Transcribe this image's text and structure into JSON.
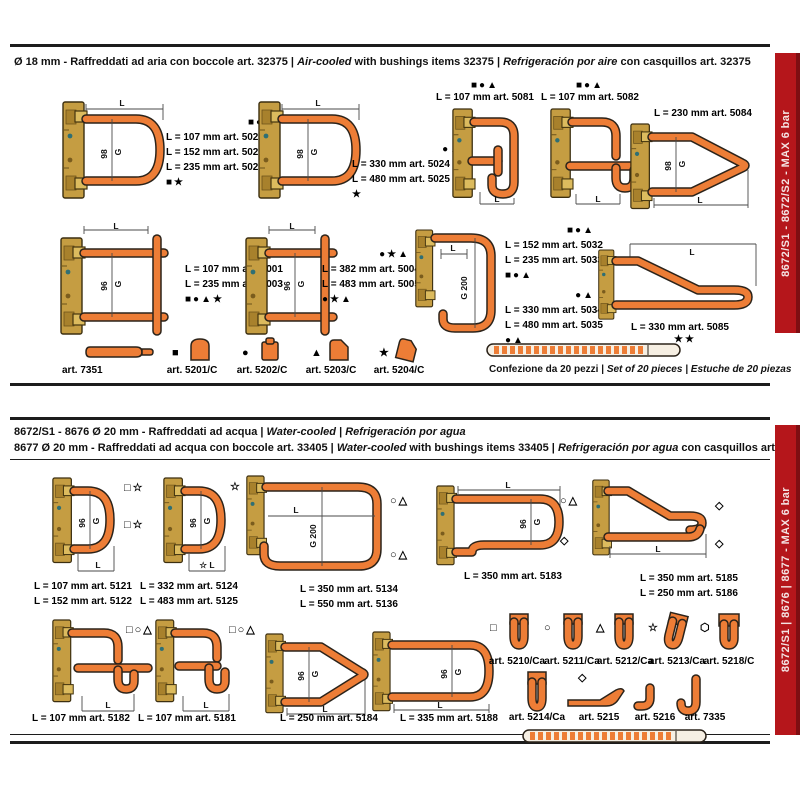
{
  "colors": {
    "red": "#b5161b",
    "red_dark": "#7e0e12",
    "orange": "#ed7d36",
    "brass": "#c59d42"
  },
  "dims": {
    "L": "L",
    "g98": "98",
    "g96": "96",
    "G": "G",
    "G200": "G 200"
  },
  "top": {
    "sidebar": "8672/S1 - 8672/S2  -  MAX 6 bar",
    "header": {
      "p1": "Ø 18 mm - Raffreddati ad aria con boccole art. 32375 | ",
      "p2i": "Air-cooled",
      "p2": " with bushings items 32375 | ",
      "p3i": "Refrigeración por aire",
      "p3": " con casquillos art. 32375"
    },
    "g1": {
      "sym_top": "■●▲",
      "l1": "L = 107 mm art. 5021",
      "l2": "L = 152 mm art. 5022",
      "l3": "L = 235 mm art. 5023",
      "sym_bottom": "■★"
    },
    "g2": {
      "sym_top": "●▲",
      "l1": "L = 330 mm art. 5024",
      "l2": "L = 480 mm art. 5025",
      "sym_bottom": "★"
    },
    "g3": {
      "sym": "■●▲",
      "l1": "L = 107 mm art. 5081"
    },
    "g4": {
      "sym": "■●▲",
      "l1": "L = 107 mm art. 5082"
    },
    "g5": {
      "l1": "L = 230 mm art. 5084"
    },
    "g6": {
      "sym_top": "■●▲★",
      "l1": "L = 107 mm art. 5001",
      "l2": "L = 235 mm art. 5003",
      "sym_bottom": "■●▲★"
    },
    "g7": {
      "sym_top": "●★▲",
      "l1": "L = 382 mm art. 5004",
      "l2": "L = 483 mm art. 5005",
      "sym_bottom": "●★▲"
    },
    "g8": {
      "sym_top": "■●▲",
      "l1": "L = 152 mm art. 5032",
      "l2": "L = 235 mm art. 5033",
      "sym_bottom": "■●▲"
    },
    "g9": {
      "sym_top": "●▲",
      "l1": "L = 330 mm art. 5034",
      "l2": "L = 480 mm art. 5035",
      "sym_bottom": "●▲"
    },
    "g10": {
      "l1": "L = 330 mm art. 5085",
      "sym_bottom": "★★"
    },
    "acc": [
      {
        "sym": "",
        "label": "art. 7351"
      },
      {
        "sym": "■",
        "label": "art. 5201/C"
      },
      {
        "sym": "●",
        "label": "art. 5202/C"
      },
      {
        "sym": "▲",
        "label": "art. 5203/C"
      },
      {
        "sym": "★",
        "label": "art. 5204/C"
      }
    ],
    "pack1": "Confezione da 20 pezzi | ",
    "pack2": "Set of 20 pieces | Estuche de 20 piezas"
  },
  "bottom": {
    "sidebar": "8672/S1 | 8676 | 8677  -  MAX 6 bar",
    "header1": {
      "p1": "8672/S1 - 8676 Ø 20 mm - Raffreddati ad acqua  | ",
      "p2i": "Water-cooled",
      "p2": " | ",
      "p3i": "Refrigeración por agua",
      "p3": ""
    },
    "header2": {
      "p1": "8677 Ø 20 mm - Raffreddati ad acqua con boccole art. 33405  | ",
      "p2i": "Water-cooled",
      "p2": " with bushings items 33405 | ",
      "p3i": "Refrigeración por agua",
      "p3": " con casquillos art. 33405"
    },
    "g1": {
      "sym_top": "□☆",
      "sym_mid": "□☆",
      "l1": "L = 107 mm art. 5121",
      "l2": "L = 152 mm art. 5122"
    },
    "g2": {
      "sym_top": "☆",
      "dim_label": "☆ L",
      "l1": "L = 332 mm art. 5124",
      "l2": "L = 483 mm art. 5125"
    },
    "g3": {
      "sym_top": "○△",
      "sym_bottom": "○△",
      "l1": "L = 350 mm art. 5134",
      "l2": "L = 550 mm art. 5136"
    },
    "g4": {
      "sym_top": "○△",
      "sym_bottom": "◇",
      "l1": "L = 350 mm art. 5183"
    },
    "g5": {
      "sym_top": "◇",
      "sym_bottom": "◇",
      "l1": "L = 350 mm art. 5185",
      "l2": "L = 250 mm art. 5186"
    },
    "g6": {
      "sym_top": "□○△",
      "l1": "L = 107 mm art. 5182"
    },
    "g7": {
      "sym_top": "□○△",
      "l1": "L = 107 mm art. 5181"
    },
    "g8": {
      "l1": "L = 250 mm art. 5184"
    },
    "g9": {
      "l1": "L = 335 mm art. 5188"
    },
    "accA": [
      {
        "sym": "□",
        "label": "art. 5210/Ca"
      },
      {
        "sym": "○",
        "label": "art. 5211/Ca"
      },
      {
        "sym": "△",
        "label": "art. 5212/Ca"
      },
      {
        "sym": "☆",
        "label": "art. 5213/Ca"
      },
      {
        "sym": "⬡",
        "label": "art. 5218/C"
      }
    ],
    "accB": [
      {
        "sym": "",
        "label": "art. 5214/Ca"
      },
      {
        "sym": "◇",
        "label": "art. 5215"
      },
      {
        "sym": "",
        "label": "art. 5216"
      },
      {
        "sym": "",
        "label": "art. 7335"
      }
    ]
  }
}
